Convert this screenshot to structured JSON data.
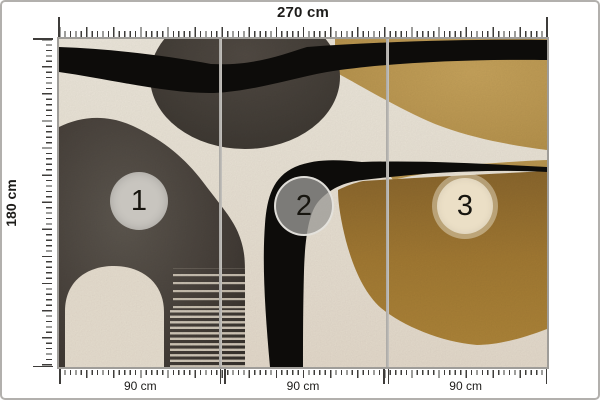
{
  "dimensions": {
    "total_width": "270 cm",
    "total_height": "180 cm"
  },
  "panels": [
    {
      "number": "1",
      "width": "90 cm"
    },
    {
      "number": "2",
      "width": "90 cm"
    },
    {
      "number": "3",
      "width": "90 cm"
    }
  ],
  "colors": {
    "background_beige": "#eae3d6",
    "charcoal_blob": "#48423c",
    "artwork_black": "#0e0d0b",
    "gold_light": "#c2a057",
    "gold_dark": "#a07a33",
    "marker_gray": "#c8c5bf",
    "marker_cream": "#ebdfc6",
    "ruler_tick": "#3e3c3a",
    "frame_gray": "#9f9d99"
  }
}
